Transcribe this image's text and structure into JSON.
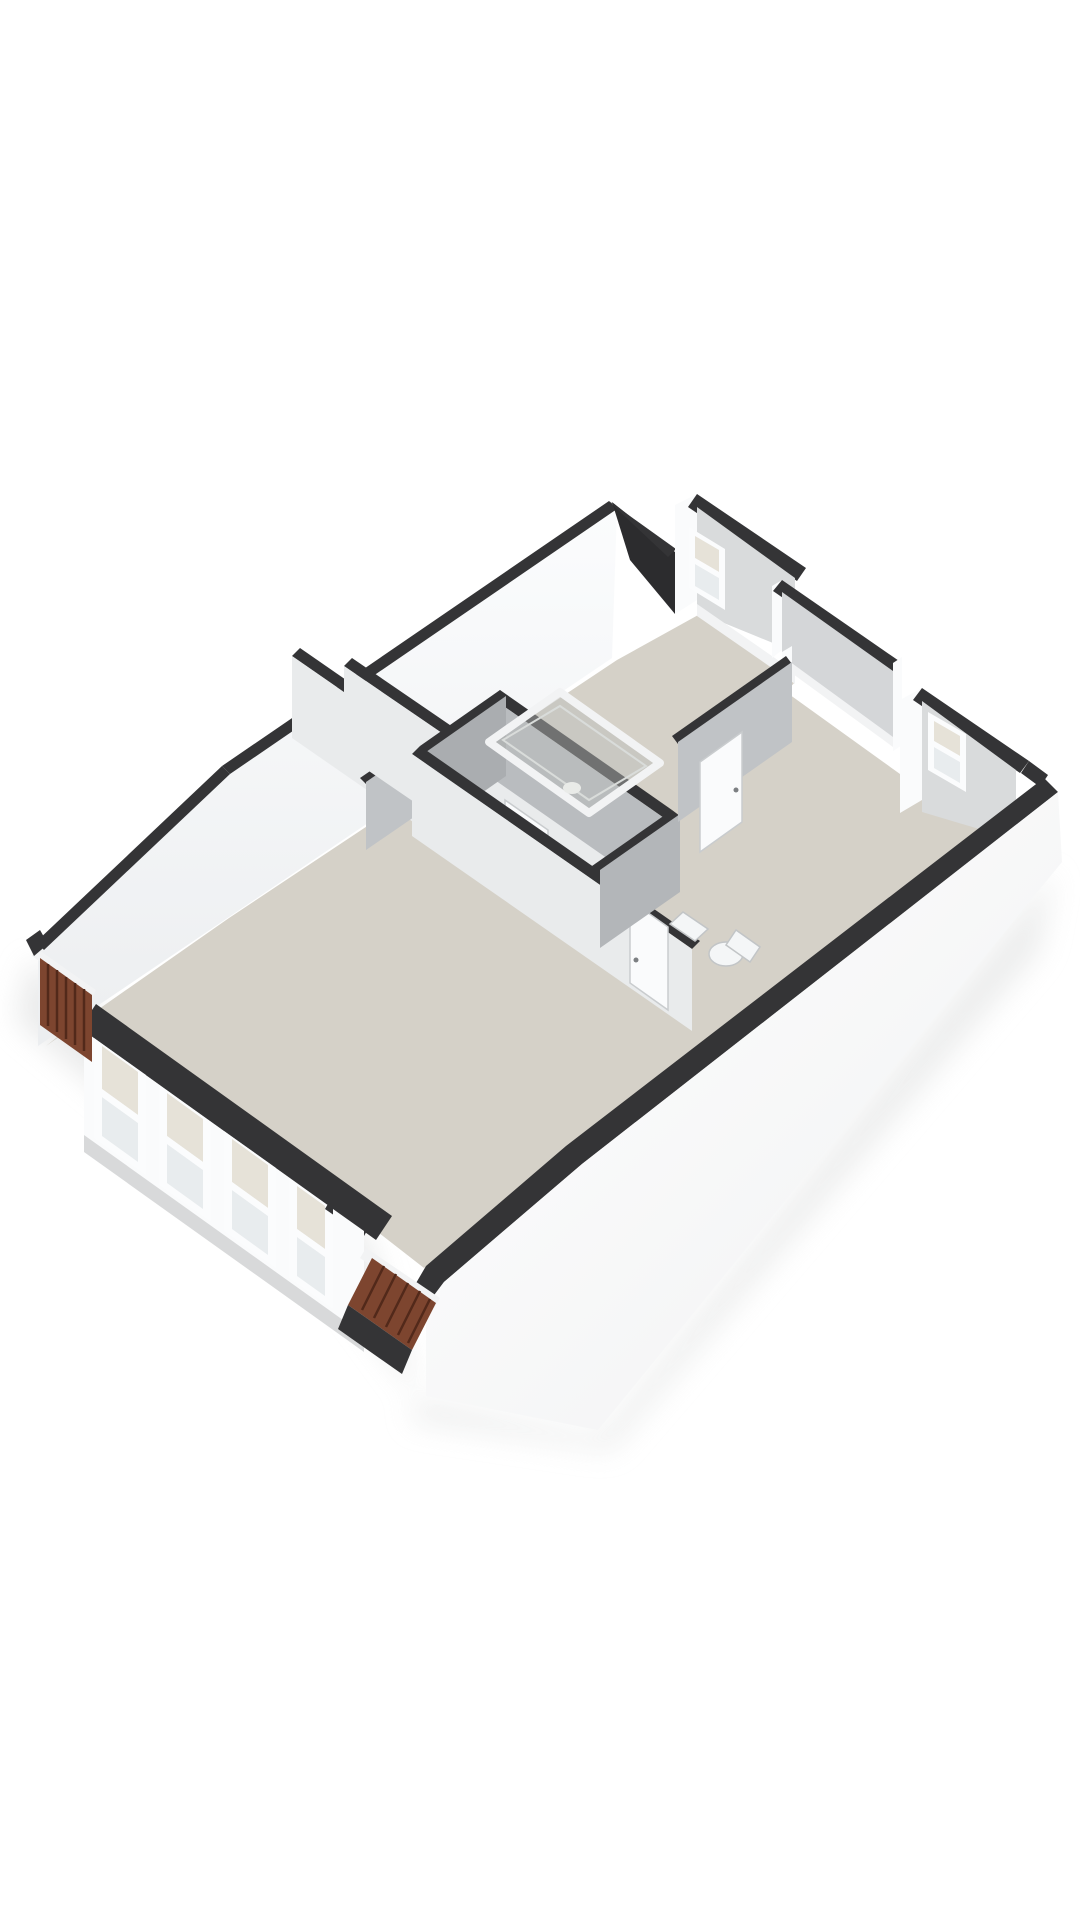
{
  "scene": {
    "kind": "3d-floorplan-render",
    "description": "Isometric cutaway 3D floor plan of an attic apartment on a white background, no text labels",
    "background": "#ffffff"
  },
  "palette": {
    "wallTop": "#343436",
    "wallTopDeep": "#2c2c2e",
    "wallWhite": "#fafbfc",
    "wallLight": "#e9ebec",
    "faceLight": "#d9dbdc",
    "faceMid": "#d4d6d8",
    "gray1": "#b9bcbf",
    "gray2": "#aaadb0",
    "gray3": "#c0c3c6",
    "gray4": "#b3b6b9",
    "floorBeige": "#d5d1c8",
    "bathFloor": "#d2cec5",
    "glass": "#e8ecee",
    "glassTint": "#e6e2d8",
    "windowFrame": "#fbfcfd",
    "trim": "#f2f3f4",
    "roofTileBrick": "#7d452f",
    "roofTileSeam": "#52291a",
    "groundShadow": "#e3e4e4"
  },
  "features": {
    "front_facade_windows": 4,
    "dormer_windows": 2,
    "interior_doors": 3,
    "roof_tile_patches": 2,
    "shower_enclosures": 1,
    "toilets": 1,
    "sinks": 1,
    "floor_finishes": [
      "beige",
      "beige-gray"
    ]
  }
}
